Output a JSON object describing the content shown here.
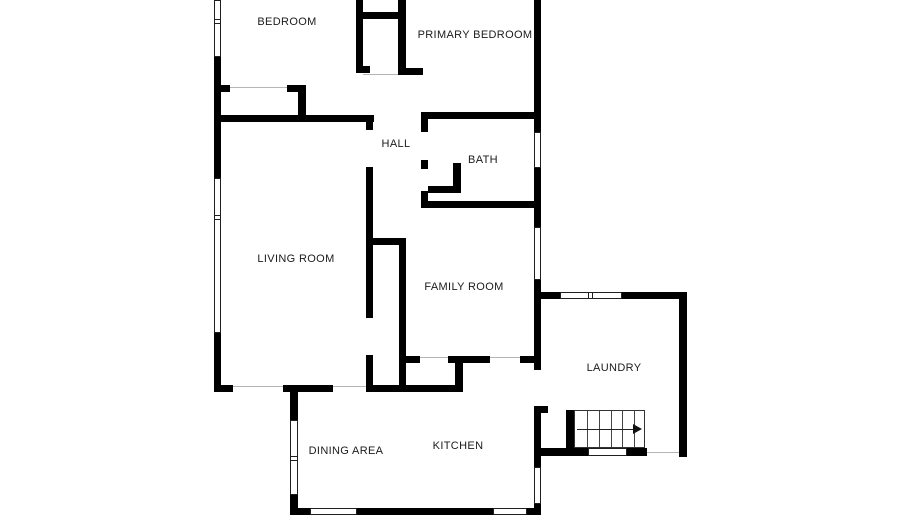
{
  "floorplan": {
    "canvas": {
      "width": 900,
      "height": 529,
      "background": "#ffffff"
    },
    "colors": {
      "wall": "#000000",
      "window_border": "#1f1f1f",
      "opening_line": "#b5b5b5",
      "stair_line": "#333333",
      "label": "#1b1b1b"
    },
    "rooms": [
      {
        "name": "bedroom",
        "label": "BEDROOM",
        "x": 287,
        "y": 22
      },
      {
        "name": "primary-bedroom",
        "label": "PRIMARY BEDROOM",
        "x": 475,
        "y": 35
      },
      {
        "name": "hall",
        "label": "HALL",
        "x": 396,
        "y": 144
      },
      {
        "name": "bath",
        "label": "BATH",
        "x": 483,
        "y": 160
      },
      {
        "name": "living-room",
        "label": "LIVING ROOM",
        "x": 296,
        "y": 259
      },
      {
        "name": "family-room",
        "label": "FAMILY ROOM",
        "x": 464,
        "y": 287
      },
      {
        "name": "laundry",
        "label": "LAUNDRY",
        "x": 614,
        "y": 368
      },
      {
        "name": "dining-area",
        "label": "DINING AREA",
        "x": 346,
        "y": 451
      },
      {
        "name": "kitchen",
        "label": "KITCHEN",
        "x": 458,
        "y": 446
      }
    ],
    "walls": [
      [
        214,
        57,
        7,
        121
      ],
      [
        214,
        333,
        7,
        59
      ],
      [
        214,
        115,
        160,
        7
      ],
      [
        221,
        85,
        9,
        7
      ],
      [
        287,
        85,
        19,
        7
      ],
      [
        298,
        85,
        8,
        37
      ],
      [
        356,
        0,
        7,
        73
      ],
      [
        356,
        12,
        50,
        7
      ],
      [
        356,
        66,
        14,
        7
      ],
      [
        398,
        0,
        8,
        75
      ],
      [
        398,
        68,
        25,
        7
      ],
      [
        534,
        0,
        7,
        132
      ],
      [
        421,
        112,
        116,
        7
      ],
      [
        421,
        112,
        7,
        20
      ],
      [
        421,
        160,
        7,
        9
      ],
      [
        453,
        163,
        8,
        27
      ],
      [
        428,
        186,
        33,
        7
      ],
      [
        421,
        191,
        7,
        17
      ],
      [
        421,
        201,
        116,
        7
      ],
      [
        534,
        168,
        7,
        59
      ],
      [
        534,
        280,
        7,
        90
      ],
      [
        534,
        406,
        7,
        61
      ],
      [
        534,
        406,
        14,
        7
      ],
      [
        534,
        504,
        7,
        11
      ],
      [
        366,
        115,
        7,
        15
      ],
      [
        366,
        167,
        7,
        151
      ],
      [
        366,
        355,
        7,
        37
      ],
      [
        366,
        238,
        40,
        7
      ],
      [
        399,
        242,
        7,
        148
      ],
      [
        406,
        356,
        14,
        7
      ],
      [
        448,
        356,
        42,
        7
      ],
      [
        520,
        356,
        14,
        7
      ],
      [
        455,
        363,
        8,
        29
      ],
      [
        366,
        385,
        97,
        7
      ],
      [
        283,
        385,
        50,
        7
      ],
      [
        214,
        385,
        19,
        7
      ],
      [
        290,
        392,
        8,
        28
      ],
      [
        290,
        495,
        8,
        20
      ],
      [
        290,
        508,
        20,
        7
      ],
      [
        357,
        508,
        136,
        7
      ],
      [
        527,
        508,
        14,
        7
      ],
      [
        534,
        292,
        26,
        7
      ],
      [
        622,
        292,
        61,
        7
      ],
      [
        679,
        292,
        8,
        165
      ],
      [
        534,
        448,
        54,
        8
      ],
      [
        627,
        448,
        20,
        8
      ],
      [
        566,
        410,
        8,
        38
      ]
    ],
    "windows": [
      {
        "x": 214,
        "y": 0,
        "w": 7,
        "h": 57,
        "o": "v",
        "bars": [
          19
        ]
      },
      {
        "x": 214,
        "y": 178,
        "w": 7,
        "h": 155,
        "o": "v",
        "bars": [
          37
        ]
      },
      {
        "x": 534,
        "y": 132,
        "w": 7,
        "h": 36,
        "o": "v",
        "bars": []
      },
      {
        "x": 534,
        "y": 227,
        "w": 7,
        "h": 53,
        "o": "v",
        "bars": []
      },
      {
        "x": 534,
        "y": 467,
        "w": 7,
        "h": 37,
        "o": "v",
        "bars": []
      },
      {
        "x": 290,
        "y": 420,
        "w": 8,
        "h": 75,
        "o": "v",
        "bars": [
          36
        ]
      },
      {
        "x": 560,
        "y": 292,
        "w": 62,
        "h": 7,
        "o": "h",
        "bars": [
          28
        ]
      },
      {
        "x": 588,
        "y": 448,
        "w": 39,
        "h": 8,
        "o": "h",
        "bars": []
      },
      {
        "x": 310,
        "y": 508,
        "w": 47,
        "h": 7,
        "o": "h",
        "bars": []
      },
      {
        "x": 493,
        "y": 508,
        "w": 34,
        "h": 7,
        "o": "h",
        "bars": []
      }
    ],
    "openings": [
      [
        230,
        87,
        57
      ],
      [
        363,
        74,
        35
      ],
      [
        233,
        386,
        50
      ],
      [
        333,
        386,
        33
      ],
      [
        420,
        357,
        28
      ],
      [
        490,
        357,
        30
      ],
      [
        647,
        452,
        32
      ]
    ],
    "stairs": {
      "x": 574,
      "y": 410,
      "w": 71,
      "h": 38,
      "tread_count": 6,
      "direction_arrow": "right"
    }
  }
}
